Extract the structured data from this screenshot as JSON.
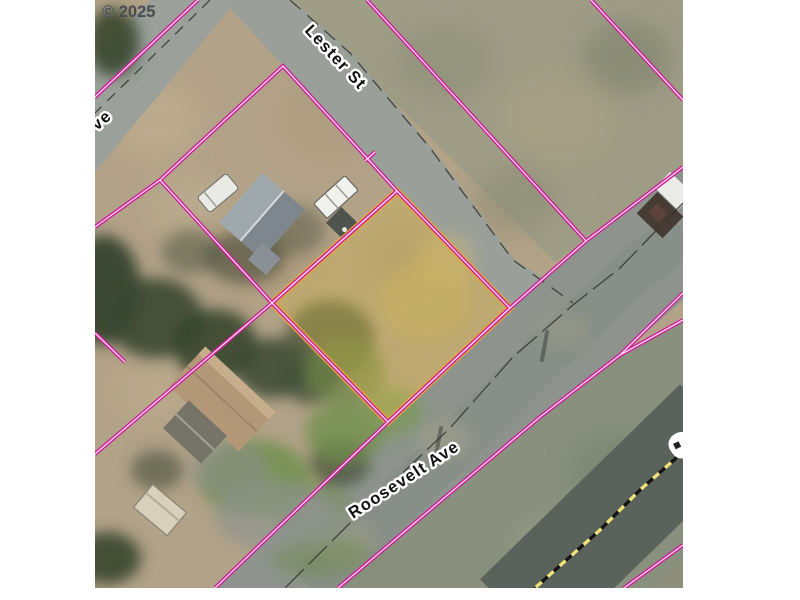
{
  "map": {
    "kind": "aerial tax-lot parcel map",
    "copyright": "© 2025",
    "street_labels": [
      {
        "id": "lester",
        "text": "Lester St"
      },
      {
        "id": "roosevelt",
        "text": "Roosevelt Ave"
      },
      {
        "id": "left_edge_partial",
        "text": "ve"
      }
    ],
    "colors": {
      "parcel_line": "#cc1f96",
      "parcel_line_core": "#ffd9f1",
      "subject_highlight_stroke": "#e2a636",
      "subject_highlight_fill": "rgba(214,184,70,0.34)",
      "highway_dash_yellow": "#efe27a",
      "highway_dash_black": "#161616",
      "road_centerline": "#33342f",
      "label_text": "#111111",
      "label_halo": "#ffffff",
      "copyright_color": "#45494c",
      "canvas_margin": "#ffffff"
    }
  }
}
